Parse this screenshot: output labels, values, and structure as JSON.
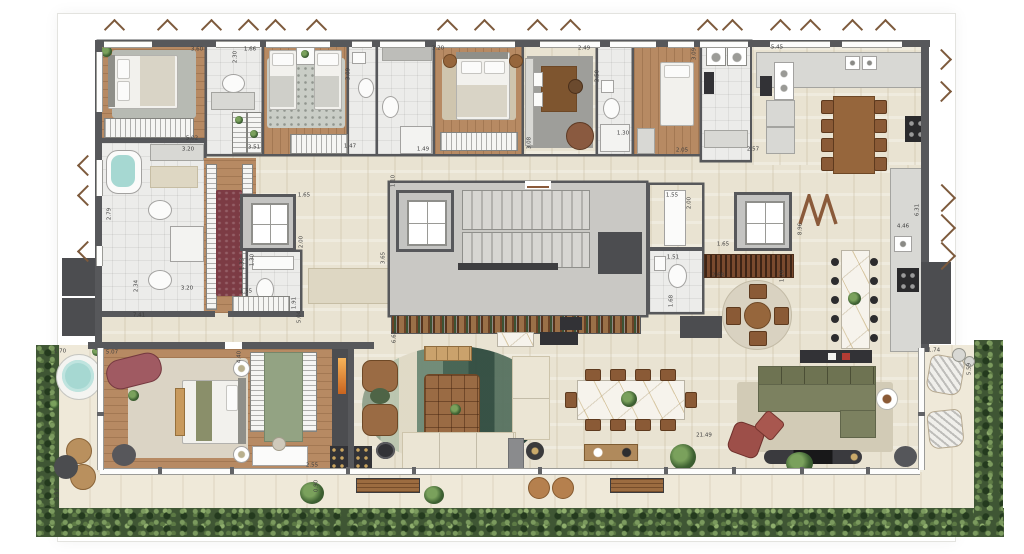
{
  "plan": {
    "palette": {
      "wall": "#57585b",
      "wood_floor": "#b78a63",
      "tile_floor": "#ececea",
      "stone_floor": "#e9e3d2",
      "terrace_floor": "#efe9d9",
      "concrete_core": "#c9c8c4",
      "hedge_green": "#3f5634",
      "runner_burgundy": "#7c3b44",
      "accent_burgundy": "#9d4f49",
      "sofa_olive": "#7c8160",
      "leather_brown": "#9a6b44",
      "marble": "#f6f3ec",
      "water": "#a6d8d2"
    },
    "dimension_labels": [
      {
        "text": "3.60",
        "x": 197,
        "y": 50
      },
      {
        "text": "2.30",
        "x": 236,
        "y": 57,
        "v": 1
      },
      {
        "text": "1.66",
        "x": 250,
        "y": 50
      },
      {
        "text": "3.09",
        "x": 349,
        "y": 74,
        "v": 1
      },
      {
        "text": "3.20",
        "x": 438,
        "y": 49
      },
      {
        "text": "2.49",
        "x": 584,
        "y": 49
      },
      {
        "text": "2.50",
        "x": 598,
        "y": 76,
        "v": 1
      },
      {
        "text": "3.09",
        "x": 695,
        "y": 54,
        "v": 1
      },
      {
        "text": "5.45",
        "x": 777,
        "y": 48
      },
      {
        "text": "5.02",
        "x": 192,
        "y": 139
      },
      {
        "text": "3.20",
        "x": 188,
        "y": 150
      },
      {
        "text": "3.51",
        "x": 254,
        "y": 148
      },
      {
        "text": "1.47",
        "x": 350,
        "y": 147
      },
      {
        "text": "1.49",
        "x": 423,
        "y": 150
      },
      {
        "text": "3.08",
        "x": 530,
        "y": 143,
        "v": 1
      },
      {
        "text": "1.30",
        "x": 623,
        "y": 134
      },
      {
        "text": "2.05",
        "x": 682,
        "y": 151
      },
      {
        "text": "2.57",
        "x": 753,
        "y": 150
      },
      {
        "text": "2.79",
        "x": 110,
        "y": 214,
        "v": 1
      },
      {
        "text": "2.34",
        "x": 137,
        "y": 286,
        "v": 1
      },
      {
        "text": "3.20",
        "x": 187,
        "y": 289
      },
      {
        "text": "7.41",
        "x": 139,
        "y": 316
      },
      {
        "text": "1.33",
        "x": 243,
        "y": 264,
        "v": 1
      },
      {
        "text": "1.65",
        "x": 304,
        "y": 196
      },
      {
        "text": "2.00",
        "x": 302,
        "y": 242,
        "v": 1
      },
      {
        "text": "1.30",
        "x": 253,
        "y": 260,
        "v": 1
      },
      {
        "text": "1.55",
        "x": 246,
        "y": 292
      },
      {
        "text": "1.91",
        "x": 295,
        "y": 303,
        "v": 1
      },
      {
        "text": "5.04",
        "x": 300,
        "y": 317,
        "v": 1
      },
      {
        "text": "1.10",
        "x": 394,
        "y": 181,
        "v": 1
      },
      {
        "text": "3.65",
        "x": 384,
        "y": 258,
        "v": 1
      },
      {
        "text": "6.62",
        "x": 395,
        "y": 337,
        "v": 1
      },
      {
        "text": "1.55",
        "x": 672,
        "y": 196
      },
      {
        "text": "2.00",
        "x": 690,
        "y": 203,
        "v": 1
      },
      {
        "text": "1.51",
        "x": 673,
        "y": 258
      },
      {
        "text": "1.68",
        "x": 672,
        "y": 301,
        "v": 1
      },
      {
        "text": "1.65",
        "x": 723,
        "y": 245
      },
      {
        "text": "2.68",
        "x": 718,
        "y": 276
      },
      {
        "text": "1.28",
        "x": 783,
        "y": 276,
        "v": 1
      },
      {
        "text": "8.96",
        "x": 801,
        "y": 229,
        "v": 1
      },
      {
        "text": "6.31",
        "x": 918,
        "y": 210,
        "v": 1
      },
      {
        "text": "4.46",
        "x": 903,
        "y": 227
      },
      {
        "text": "1.70",
        "x": 60,
        "y": 352
      },
      {
        "text": "5.07",
        "x": 112,
        "y": 353
      },
      {
        "text": "4.40",
        "x": 240,
        "y": 357,
        "v": 1
      },
      {
        "text": "2.55",
        "x": 312,
        "y": 466
      },
      {
        "text": "0.90",
        "x": 317,
        "y": 486,
        "v": 1
      },
      {
        "text": "5.57",
        "x": 58,
        "y": 494,
        "v": 1
      },
      {
        "text": "1.74",
        "x": 934,
        "y": 351
      },
      {
        "text": "5.59",
        "x": 970,
        "y": 369,
        "v": 1
      },
      {
        "text": "21.49",
        "x": 704,
        "y": 436
      }
    ]
  }
}
